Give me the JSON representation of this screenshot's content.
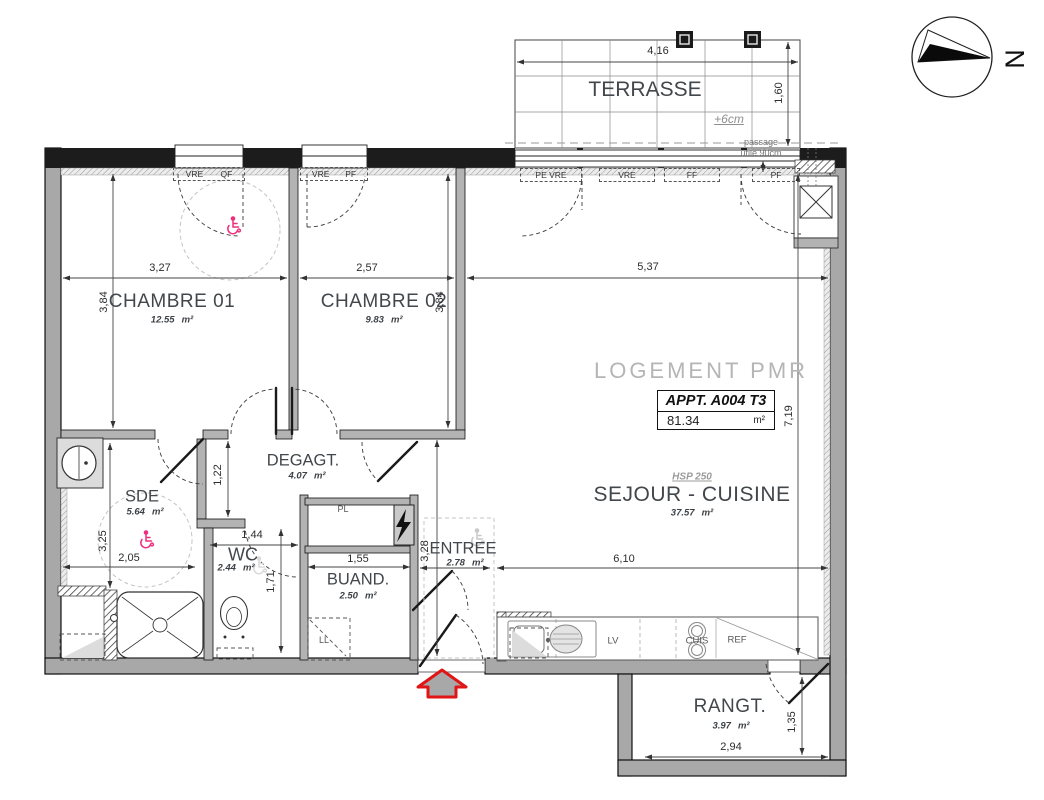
{
  "meta": {
    "north_label": "N"
  },
  "terrace": {
    "label": "TERRASSE",
    "width_dim": "4,16",
    "height_dim": "1,60",
    "level_note": "+6cm",
    "passage_line1": "passage",
    "passage_line2": "utile 90cm"
  },
  "apartment": {
    "watermark": "LOGEMENT PMR",
    "tag": "APPT. A004 T3",
    "total_area": "81.34",
    "unit": "m²",
    "hsp": "HSP 250"
  },
  "rooms": {
    "chambre1": {
      "label": "CHAMBRE 01",
      "area": "12.55"
    },
    "chambre2": {
      "label": "CHAMBRE 02",
      "area": "9.83"
    },
    "sejour": {
      "label": "SEJOUR - CUISINE",
      "area": "37.57"
    },
    "degagt": {
      "label": "DEGAGT.",
      "area": "4.07"
    },
    "sde": {
      "label": "SDE",
      "area": "5.64"
    },
    "wc": {
      "label": "WC",
      "area": "2.44"
    },
    "buand": {
      "label": "BUAND.",
      "area": "2.50"
    },
    "entree": {
      "label": "ENTREE",
      "area": "2.78"
    },
    "rangt": {
      "label": "RANGT.",
      "area": "3.97"
    }
  },
  "dims": {
    "ch1_w": "3,27",
    "ch1_h": "3,84",
    "ch2_w": "2,57",
    "ch2_h": "3,84",
    "sejour_w": "5,37",
    "sejour_h": "7,19",
    "sejour_b": "6,10",
    "sde_h": "3,25",
    "sde_w": "2,05",
    "wc_corridor": "1,22",
    "wc_w": "1,44",
    "wc_h": "1,71",
    "buand_w": "1,55",
    "entree_h": "3,28",
    "rangt_w": "2,94",
    "rangt_h": "1,35"
  },
  "openings": {
    "w1a": "VRE",
    "w1b": "QF",
    "w2a": "VRE",
    "w2b": "PF",
    "t1": "PE VRE",
    "t2": "VRE",
    "t3": "FF",
    "t4": "PF"
  },
  "fixtures": {
    "pl": "PL",
    "ll": "LL",
    "lv": "LV",
    "cuis": "CUIS",
    "ref": "REF"
  },
  "colors": {
    "accent_pink": "#ee2f7d",
    "entry_arrow_red": "#e01616",
    "watermark_gray": "#b5b5b5",
    "wall_gray": "#a8a8a8",
    "facade_black": "#1c1c1c"
  }
}
